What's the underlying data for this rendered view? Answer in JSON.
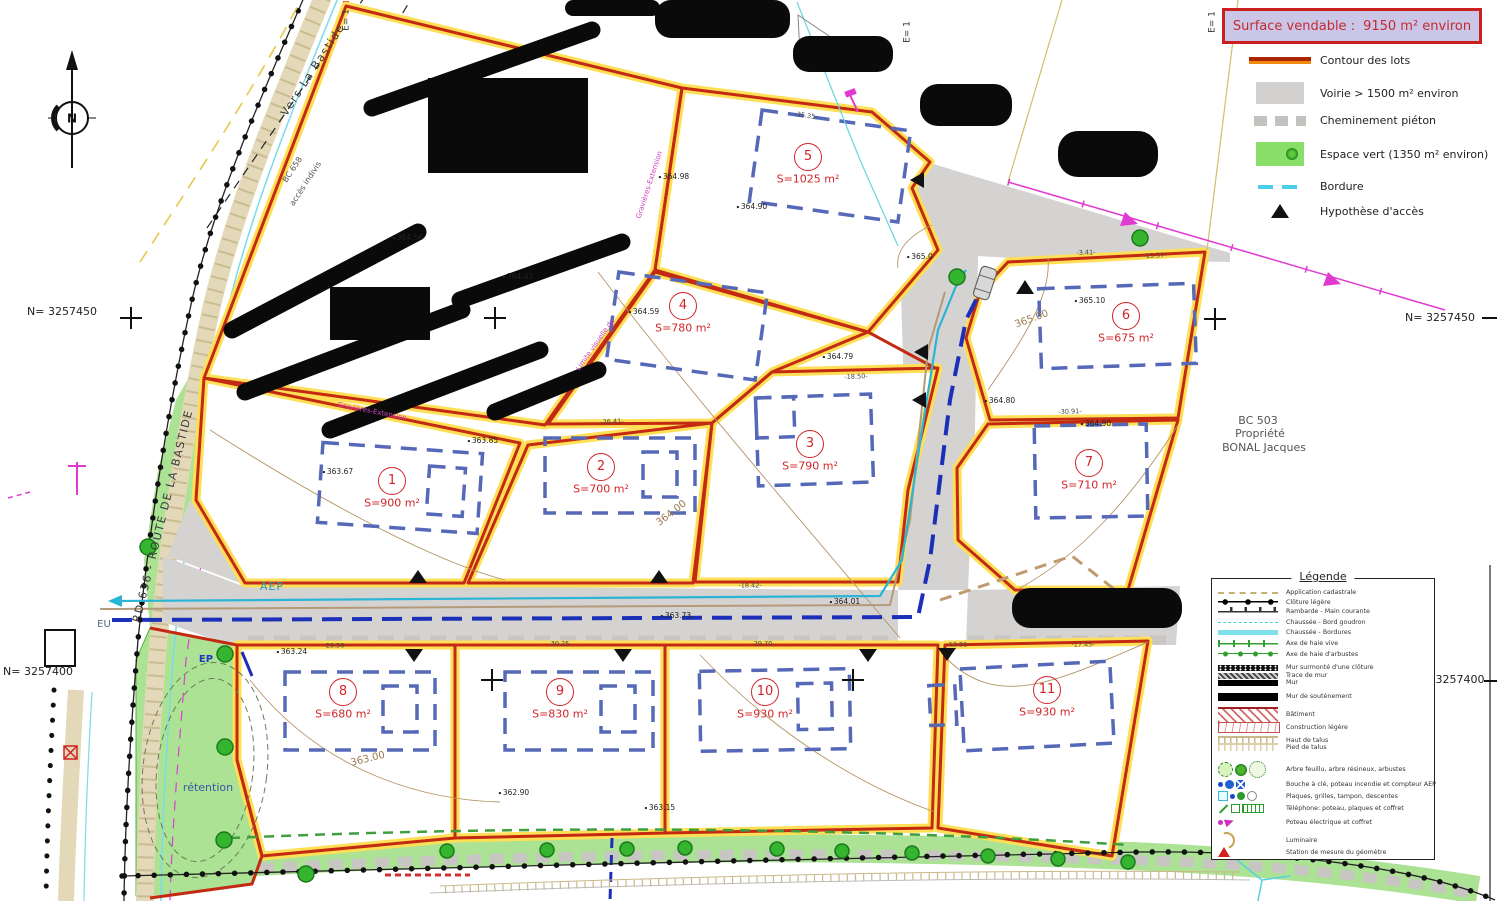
{
  "title_box": {
    "label": "Surface vendable :",
    "value": "9150 m²  environ"
  },
  "legend_top": [
    {
      "type": "contour",
      "label": "Contour des lots"
    },
    {
      "type": "voirie",
      "label": "Voirie > 1500 m²  environ"
    },
    {
      "type": "chemin",
      "label": "Cheminement piéton"
    },
    {
      "type": "vert",
      "label": "Espace vert  (1350 m² environ)"
    },
    {
      "type": "bordure",
      "label": "Bordure"
    },
    {
      "type": "acces",
      "label": "Hypothèse d'accès"
    }
  ],
  "legend_panel": {
    "title": "Légende",
    "items": [
      {
        "type": "cadastral",
        "label": "Application cadastrale"
      },
      {
        "type": "cloture",
        "label": "Clôture légère"
      },
      {
        "type": "rambarde",
        "label": "Rambarde - Main courante"
      },
      {
        "type": "bordgoudron",
        "label": "Chaussée - Bord goudron"
      },
      {
        "type": "bordures",
        "label": "Chaussée - Bordures"
      },
      {
        "type": "haievive",
        "label": "Axe de haie vive"
      },
      {
        "type": "haiearb",
        "label": "Axe de haie d'arbustes"
      },
      {
        "type": "murcloture",
        "label": "Mur surmonté d'une clôture"
      },
      {
        "type": "tracemur",
        "label": "Trace de mur"
      },
      {
        "type": "mur",
        "label": "Mur"
      },
      {
        "type": "soutenement",
        "label": "Mur de soutènement"
      },
      {
        "type": "batiment",
        "label": "Bâtiment"
      },
      {
        "type": "constr",
        "label": "Construction légère"
      },
      {
        "type": "hauttalus",
        "label": "Haut de talus"
      },
      {
        "type": "piedtalus",
        "label": "Pied de talus"
      },
      {
        "type": "arbres",
        "label": "Arbre feuillu, arbre résineux, arbustes"
      },
      {
        "type": "aepsym",
        "label": "Bouche à clé, poteau incendie et compteur AEP"
      },
      {
        "type": "plaques",
        "label": "Plaques, grilles, tampon, descentes"
      },
      {
        "type": "telephone",
        "label": "Téléphone: poteau, plaques et coffret"
      },
      {
        "type": "poteau",
        "label": "Poteau électrique et coffret"
      },
      {
        "type": "luminaire",
        "label": "Luminaire"
      },
      {
        "type": "station",
        "label": "Station de mesure du géomètre"
      }
    ]
  },
  "lots": [
    {
      "num": "1",
      "area": "S=900 m²",
      "cx": 392,
      "cy": 481
    },
    {
      "num": "2",
      "area": "S=700 m²",
      "cx": 601,
      "cy": 467
    },
    {
      "num": "3",
      "area": "S=790 m²",
      "cx": 810,
      "cy": 444
    },
    {
      "num": "4",
      "area": "S=780 m²",
      "cx": 683,
      "cy": 306
    },
    {
      "num": "5",
      "area": "S=1025 m²",
      "cx": 808,
      "cy": 157
    },
    {
      "num": "6",
      "area": "S=675 m²",
      "cx": 1126,
      "cy": 316
    },
    {
      "num": "7",
      "area": "S=710 m²",
      "cx": 1089,
      "cy": 463
    },
    {
      "num": "8",
      "area": "S=680 m²",
      "cx": 343,
      "cy": 692
    },
    {
      "num": "9",
      "area": "S=830 m²",
      "cx": 560,
      "cy": 692
    },
    {
      "num": "10",
      "area": "S=930 m²",
      "cx": 765,
      "cy": 692
    },
    {
      "num": "11",
      "area": "S=930 m²",
      "cx": 1047,
      "cy": 690
    }
  ],
  "labels": [
    {
      "t": "RD 636 - ROUTE DE LA BASTIDE",
      "x": 163,
      "y": 516,
      "r": -76,
      "c": "roadname"
    },
    {
      "t": "Vers La Bastide",
      "x": 313,
      "y": 70,
      "r": -57,
      "c": "roadname"
    },
    {
      "t": "BC 658",
      "x": 293,
      "y": 170,
      "r": -57,
      "c": "smallref"
    },
    {
      "t": "accès indivis",
      "x": 306,
      "y": 184,
      "r": -57,
      "c": "smallref"
    },
    {
      "t": "BC 503",
      "x": 1258,
      "y": 421,
      "r": 0,
      "c": "parcelref"
    },
    {
      "t": "Propriété",
      "x": 1260,
      "y": 434,
      "r": 0,
      "c": "parcelref"
    },
    {
      "t": "BONAL Jacques",
      "x": 1264,
      "y": 448,
      "r": 0,
      "c": "parcelref"
    },
    {
      "t": "N= 3257450",
      "x": 62,
      "y": 312,
      "r": 0,
      "c": "coord"
    },
    {
      "t": "N= 3257450",
      "x": 1440,
      "y": 318,
      "r": 0,
      "c": "coord"
    },
    {
      "t": "N= 3257400",
      "x": 38,
      "y": 672,
      "r": 0,
      "c": "coord"
    },
    {
      "t": "3257400",
      "x": 1460,
      "y": 680,
      "r": 0,
      "c": "coord"
    },
    {
      "t": "E= 1",
      "x": 347,
      "y": 20,
      "r": -90,
      "c": "eref"
    },
    {
      "t": "E= 1",
      "x": 908,
      "y": 32,
      "r": -90,
      "c": "eref"
    },
    {
      "t": "E= 1",
      "x": 1213,
      "y": 22,
      "r": -90,
      "c": "eref"
    },
    {
      "t": "AEP",
      "x": 272,
      "y": 587,
      "r": 0,
      "c": "aep"
    },
    {
      "t": "EU",
      "x": 104,
      "y": 625,
      "r": 0,
      "c": "eu"
    },
    {
      "t": "EP",
      "x": 206,
      "y": 660,
      "r": 0,
      "c": "ep"
    },
    {
      "t": "rétention",
      "x": 208,
      "y": 788,
      "r": 0,
      "c": "retention"
    },
    {
      "t": "Gravières-Extension",
      "x": 372,
      "y": 412,
      "r": 11,
      "c": "note"
    },
    {
      "t": "Gravières-Extension",
      "x": 650,
      "y": 185,
      "r": -72,
      "c": "note"
    },
    {
      "t": "Limite visuelle du",
      "x": 596,
      "y": 345,
      "r": -55,
      "c": "note"
    },
    {
      "t": "365.00",
      "x": 1032,
      "y": 320,
      "r": -20,
      "c": "contour"
    },
    {
      "t": "364.00",
      "x": 672,
      "y": 514,
      "r": -38,
      "c": "contour"
    },
    {
      "t": "363.00",
      "x": 368,
      "y": 760,
      "r": -14,
      "c": "contour"
    },
    {
      "t": "364.98",
      "x": 674,
      "y": 177,
      "r": 0,
      "c": "spot"
    },
    {
      "t": "364.90",
      "x": 752,
      "y": 207,
      "r": 0,
      "c": "spot"
    },
    {
      "t": "364.56",
      "x": 408,
      "y": 238,
      "r": 0,
      "c": "spot"
    },
    {
      "t": "364.43",
      "x": 518,
      "y": 277,
      "r": 0,
      "c": "spot"
    },
    {
      "t": "363.85",
      "x": 483,
      "y": 441,
      "r": 0,
      "c": "spot"
    },
    {
      "t": "363.67",
      "x": 338,
      "y": 472,
      "r": 0,
      "c": "spot"
    },
    {
      "t": "364.59",
      "x": 644,
      "y": 312,
      "r": 0,
      "c": "spot"
    },
    {
      "t": "364.79",
      "x": 838,
      "y": 357,
      "r": 0,
      "c": "spot"
    },
    {
      "t": "364.80",
      "x": 1000,
      "y": 401,
      "r": 0,
      "c": "spot"
    },
    {
      "t": "364.90",
      "x": 1096,
      "y": 424,
      "r": 0,
      "c": "spot"
    },
    {
      "t": "365.10",
      "x": 1090,
      "y": 301,
      "r": 0,
      "c": "spot"
    },
    {
      "t": "365.0",
      "x": 920,
      "y": 257,
      "r": 0,
      "c": "spot"
    },
    {
      "t": "363.24",
      "x": 292,
      "y": 652,
      "r": 0,
      "c": "spot"
    },
    {
      "t": "362.90",
      "x": 514,
      "y": 793,
      "r": 0,
      "c": "spot"
    },
    {
      "t": "363.15",
      "x": 660,
      "y": 808,
      "r": 0,
      "c": "spot"
    },
    {
      "t": "363.71",
      "x": 1350,
      "y": 827,
      "r": 0,
      "c": "spot"
    },
    {
      "t": "364.01",
      "x": 845,
      "y": 602,
      "r": 0,
      "c": "spot"
    },
    {
      "t": "363.73",
      "x": 676,
      "y": 616,
      "r": 0,
      "c": "spot"
    },
    {
      "t": "-35.35-",
      "x": 806,
      "y": 116,
      "r": 8,
      "c": "dim"
    },
    {
      "t": "-26.41-",
      "x": 612,
      "y": 422,
      "r": -3,
      "c": "dim"
    },
    {
      "t": "-18.50-",
      "x": 856,
      "y": 377,
      "r": -2,
      "c": "dim"
    },
    {
      "t": "-3.41-",
      "x": 1086,
      "y": 253,
      "r": -2,
      "c": "dim"
    },
    {
      "t": "-15.57-",
      "x": 1155,
      "y": 256,
      "r": -3,
      "c": "dim"
    },
    {
      "t": "-30.91-",
      "x": 1070,
      "y": 412,
      "r": -2,
      "c": "dim"
    },
    {
      "t": "-18.42-",
      "x": 750,
      "y": 586,
      "r": 0,
      "c": "dim"
    },
    {
      "t": "-29.36-",
      "x": 335,
      "y": 646,
      "r": 0,
      "c": "dim"
    },
    {
      "t": "-30.25-",
      "x": 560,
      "y": 644,
      "r": 0,
      "c": "dim"
    },
    {
      "t": "-29.70-",
      "x": 763,
      "y": 644,
      "r": 0,
      "c": "dim"
    },
    {
      "t": "-13.91-",
      "x": 958,
      "y": 645,
      "r": 0,
      "c": "dim"
    },
    {
      "t": "-17.45-",
      "x": 1083,
      "y": 645,
      "r": 0,
      "c": "dim"
    },
    {
      "t": "N",
      "x": 72,
      "y": 119,
      "r": 0,
      "c": "compass"
    }
  ],
  "colors": {
    "lot_border": "#c42a12",
    "lot_halo": "#ffdf55",
    "espace_vert": "#abe293",
    "voirie": "#d5d3d1",
    "bordure": "#55d0e4",
    "envelope": "#5668b8",
    "eu_line": "#1c2fb8",
    "aep_line": "#2ab4d6",
    "accent_red": "#c62a30",
    "title_bg": "#c9c6e8"
  }
}
